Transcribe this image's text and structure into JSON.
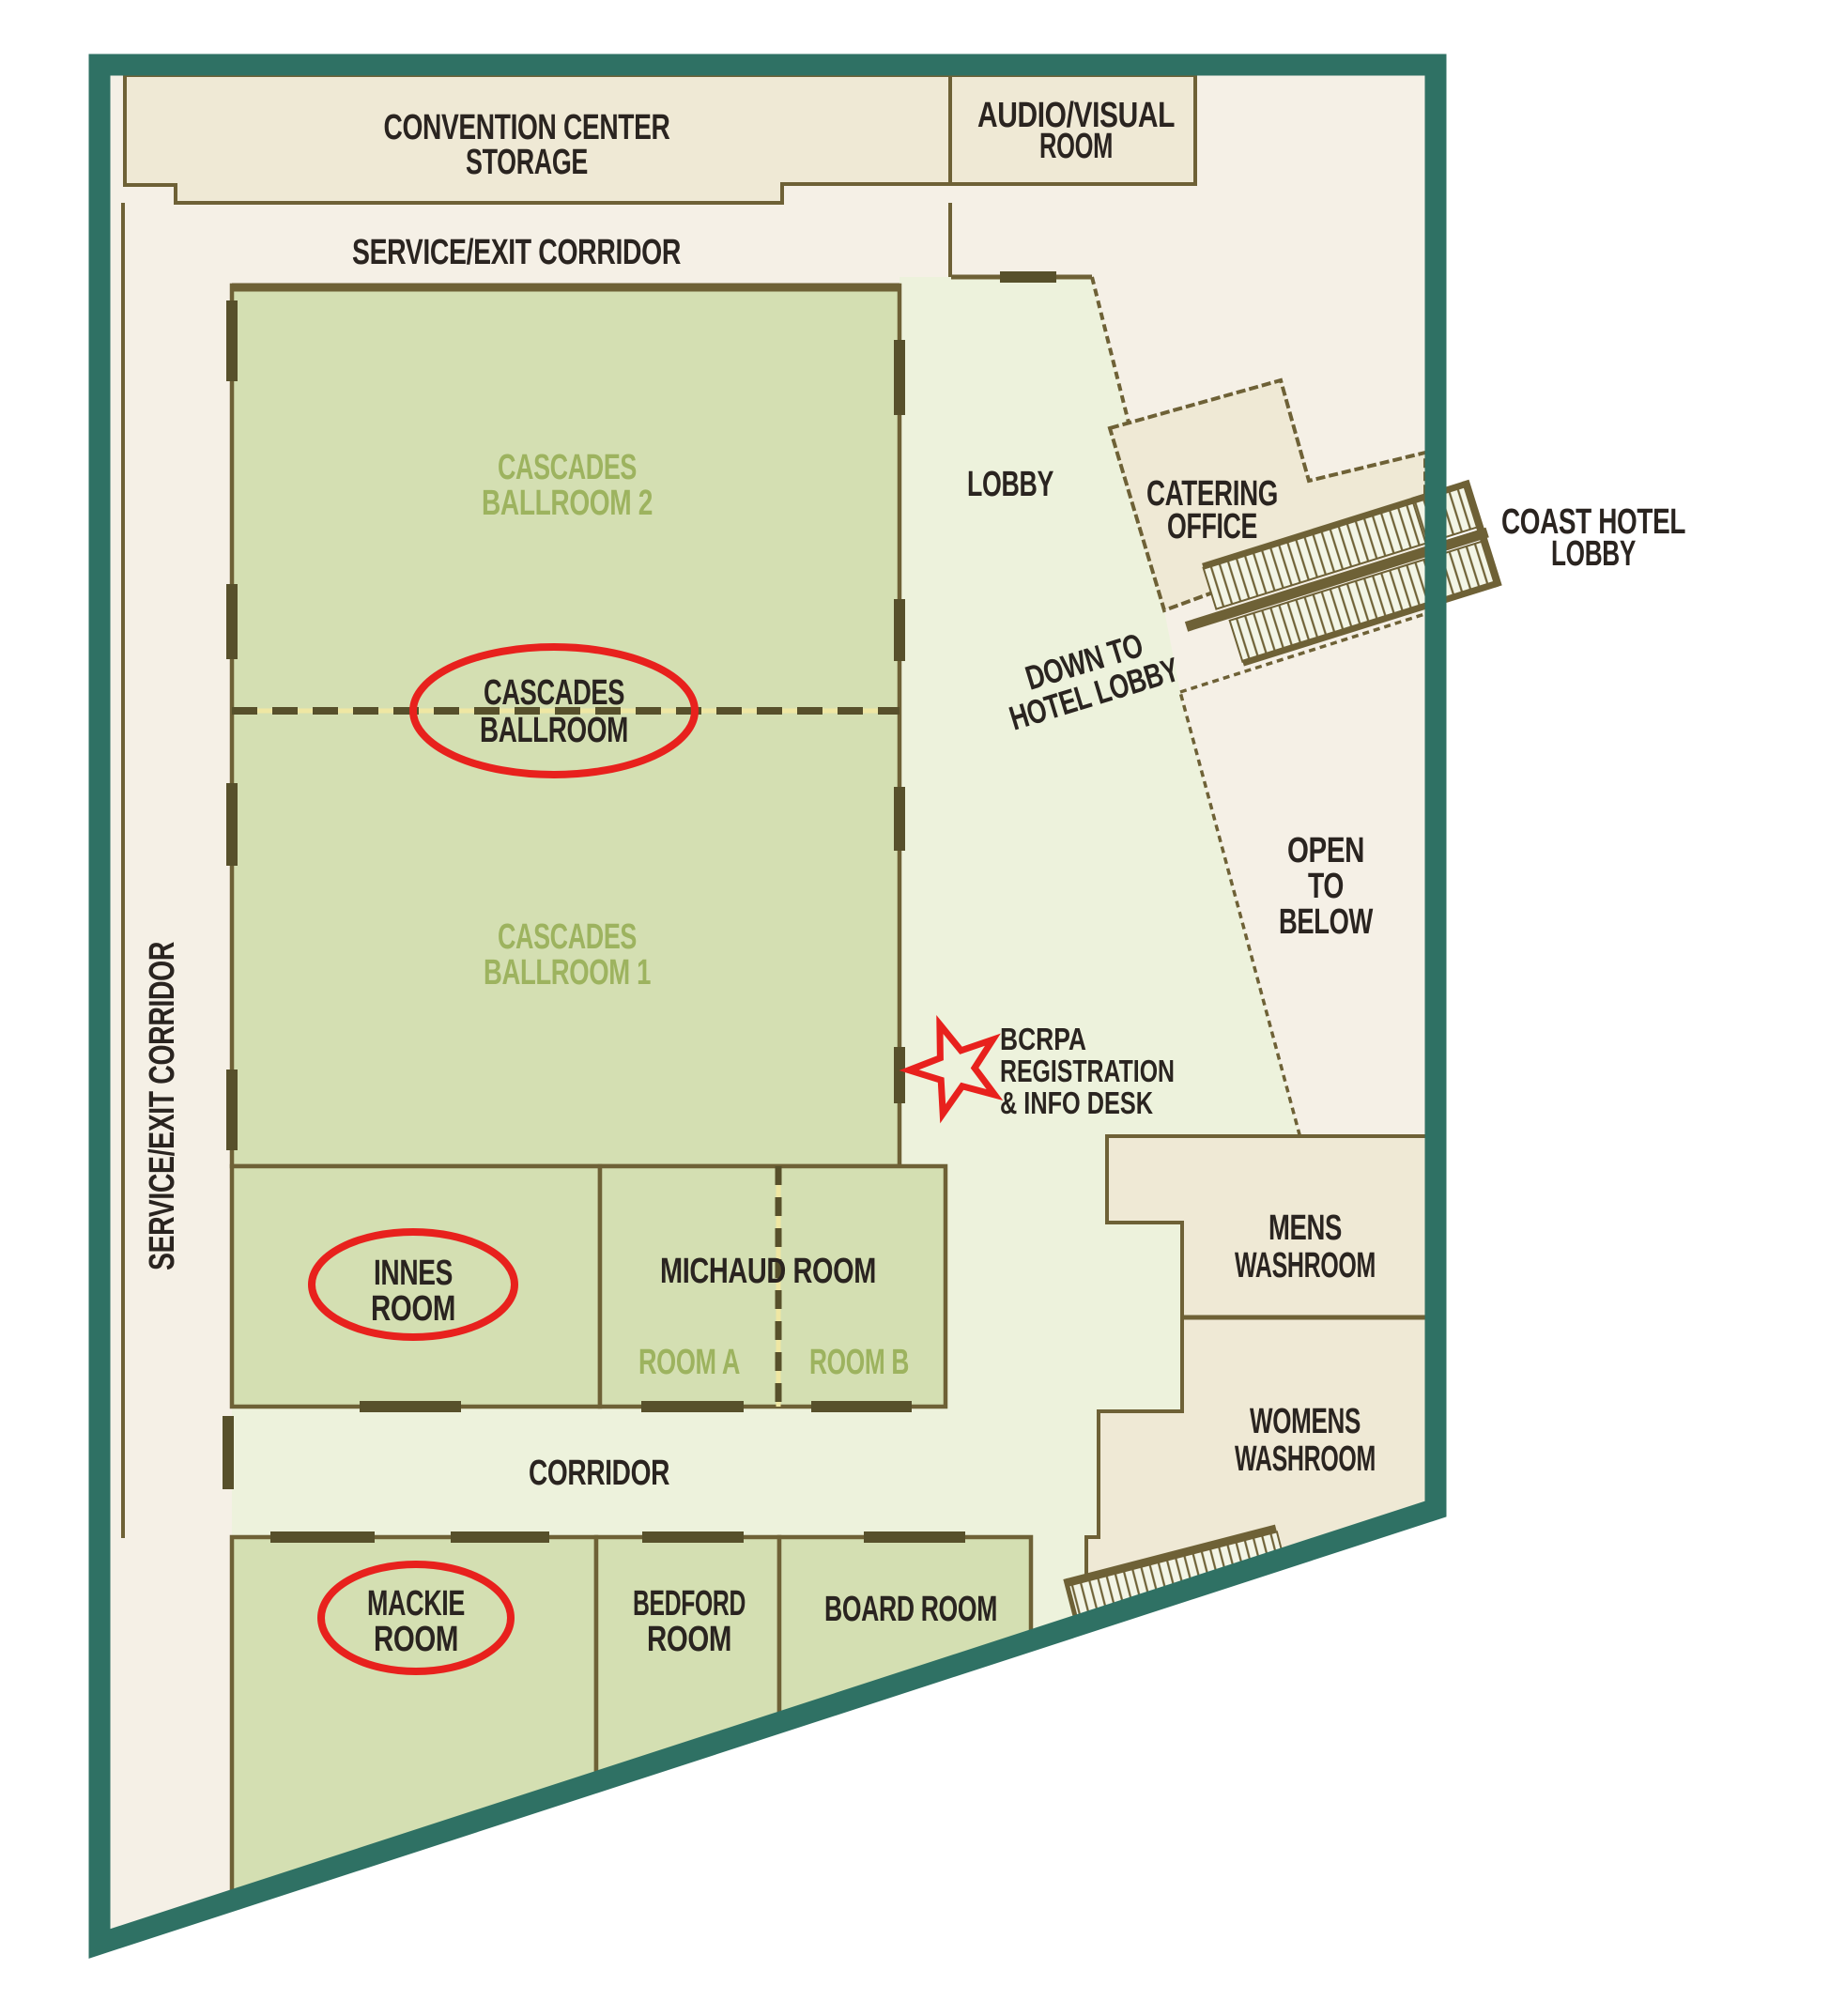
{
  "colors": {
    "teal": "#2F7164",
    "wall": "#6E6136",
    "door": "#57502B",
    "ink": "#2A2420",
    "green-text": "#9DB35F",
    "room-green": "#D4DFB2",
    "light-green": "#EDF2DC",
    "beige": "#F5F0E6",
    "beige-dark": "#EFE9D5",
    "red": "#E8211D",
    "dash-underlay": "#EFE7A3"
  },
  "labels": {
    "storage": {
      "line1": "CONVENTION CENTER",
      "line2": "STORAGE"
    },
    "av": {
      "line1": "AUDIO/VISUAL",
      "line2": "ROOM"
    },
    "service_top": "SERVICE/EXIT CORRIDOR",
    "service_left": "SERVICE/EXIT CORRIDOR",
    "ballroom2": {
      "line1": "CASCADES",
      "line2": "BALLROOM 2"
    },
    "ballroom1": {
      "line1": "CASCADES",
      "line2": "BALLROOM 1"
    },
    "ballroom_circled": {
      "line1": "CASCADES",
      "line2": "BALLROOM"
    },
    "lobby": "LOBBY",
    "catering": {
      "line1": "CATERING",
      "line2": "OFFICE"
    },
    "coast": {
      "line1": "COAST HOTEL",
      "line2": "LOBBY"
    },
    "down_to": {
      "line1": "DOWN TO",
      "line2": "HOTEL LOBBY"
    },
    "open_below": {
      "line1": "OPEN",
      "line2": "TO",
      "line3": "BELOW"
    },
    "registration": {
      "line1": "BCRPA",
      "line2": "REGISTRATION",
      "line3": "& INFO DESK"
    },
    "mens": {
      "line1": "MENS",
      "line2": "WASHROOM"
    },
    "womens": {
      "line1": "WOMENS",
      "line2": "WASHROOM"
    },
    "innes": {
      "line1": "INNES",
      "line2": "ROOM"
    },
    "michaud": "MICHAUD ROOM",
    "room_a": "ROOM A",
    "room_b": "ROOM B",
    "corridor": "CORRIDOR",
    "mackie": {
      "line1": "MACKIE",
      "line2": "ROOM"
    },
    "bedford": {
      "line1": "BEDFORD",
      "line2": "ROOM"
    },
    "board": "BOARD ROOM"
  }
}
